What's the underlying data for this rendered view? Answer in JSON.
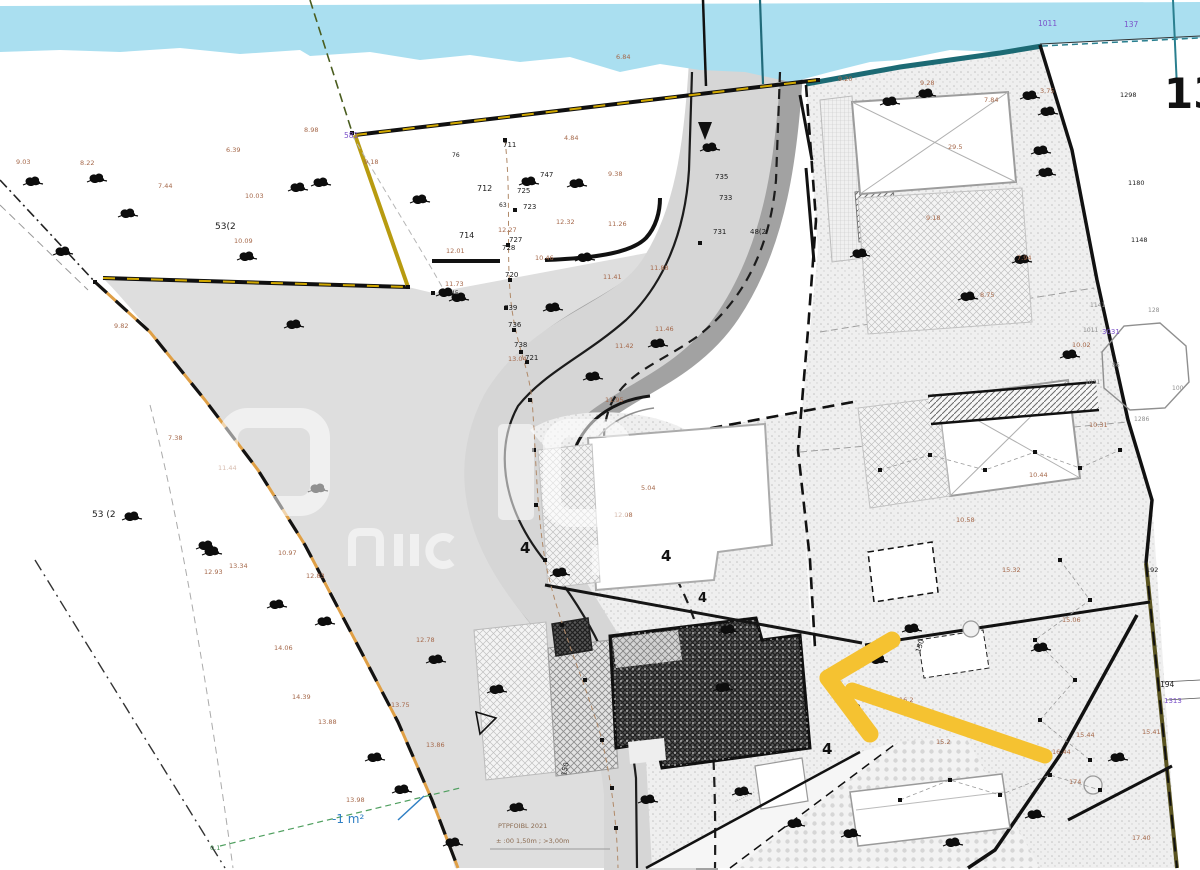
{
  "map_title": "cadastral-site-plan",
  "big_label": "13",
  "notes": {
    "survey_line1": "PTPFOIBL 2021",
    "survey_line2": "± :00 1,50m ; >3,00m"
  },
  "colors": {
    "water": "#aadff0",
    "water_edge": "#1c6a74",
    "road": "#d6d6d6",
    "road_dark": "#a2a2a2",
    "verge": "#dedede",
    "boundary_yellow": "#d1a800",
    "boundary_orange": "#df9f45",
    "arrow": "#f5c231",
    "note_blue": "#2f7fc4",
    "label_brown": "#a5684a",
    "label_purple": "#7b52c9",
    "highlight_outline": "#101010"
  },
  "labels": [
    [
      "712",
      477,
      191,
      "bk",
      8
    ],
    [
      "714",
      459,
      238,
      "bk",
      8
    ],
    [
      "711",
      503,
      147,
      "bk",
      7
    ],
    [
      "76",
      452,
      157,
      "bk",
      6
    ],
    [
      "747",
      540,
      177,
      "bk",
      7
    ],
    [
      "725",
      517,
      193,
      "bk",
      7
    ],
    [
      "723",
      523,
      209,
      "bk",
      7
    ],
    [
      "63",
      499,
      207,
      "bk",
      6
    ],
    [
      "727",
      509,
      242,
      "bk",
      7
    ],
    [
      "728",
      502,
      250,
      "bk",
      7
    ],
    [
      "720",
      505,
      277,
      "bk",
      7
    ],
    [
      "739",
      504,
      310,
      "bk",
      7
    ],
    [
      "736",
      508,
      327,
      "bk",
      7
    ],
    [
      "738",
      514,
      347,
      "bk",
      7
    ],
    [
      "721",
      525,
      360,
      "bk",
      7
    ],
    [
      "45",
      451,
      295,
      "bk",
      6
    ],
    [
      "735",
      715,
      179,
      "bk",
      7
    ],
    [
      "733",
      719,
      200,
      "bk",
      7
    ],
    [
      "731",
      713,
      234,
      "bk",
      7
    ],
    [
      "48(2",
      750,
      234,
      "bk",
      7
    ],
    [
      "53(2",
      215,
      229,
      "bk",
      9
    ],
    [
      "53 (2",
      92,
      517,
      "bk",
      9
    ],
    [
      "192",
      1146,
      572,
      "bk",
      6.5
    ],
    [
      "194",
      1160,
      687,
      "bk",
      7.5
    ],
    [
      "1180",
      1128,
      185,
      "bk",
      6.5
    ],
    [
      "1148",
      1131,
      242,
      "bk",
      6.5
    ],
    [
      "1298",
      1120,
      97,
      "bk",
      6.5
    ],
    [
      "581",
      344,
      138,
      "pu",
      7.5
    ],
    [
      "1011",
      1038,
      26,
      "pu",
      7.5
    ],
    [
      "137",
      1124,
      27,
      "pu",
      7.5
    ],
    [
      "3031",
      1102,
      334,
      "pu",
      7
    ],
    [
      "1313",
      1164,
      703,
      "pu",
      7
    ],
    [
      "9.03",
      16,
      164,
      "bn",
      6.5
    ],
    [
      "8.22",
      80,
      165,
      "bn",
      6.5
    ],
    [
      "7.44",
      158,
      188,
      "bn",
      6.5
    ],
    [
      "10.03",
      245,
      198,
      "bn",
      6.5
    ],
    [
      "6.39",
      226,
      152,
      "bn",
      6.5
    ],
    [
      "8.98",
      304,
      132,
      "bn",
      6.5
    ],
    [
      "9.18",
      364,
      164,
      "bn",
      6.5
    ],
    [
      "4.84",
      564,
      140,
      "bn",
      6.5
    ],
    [
      "9.38",
      608,
      176,
      "bn",
      6.5
    ],
    [
      "12.32",
      556,
      224,
      "bn",
      6.5
    ],
    [
      "11.26",
      608,
      226,
      "bn",
      6.5
    ],
    [
      "12.27",
      498,
      232,
      "bn",
      6.5
    ],
    [
      "10.46",
      535,
      260,
      "bn",
      6.5
    ],
    [
      "12.01",
      446,
      253,
      "bn",
      6.5
    ],
    [
      "11.88",
      650,
      270,
      "bn",
      6.5
    ],
    [
      "11.41",
      603,
      279,
      "bn",
      6.5
    ],
    [
      "11.46",
      655,
      331,
      "bn",
      6.5
    ],
    [
      "11.42",
      615,
      348,
      "bn",
      6.5
    ],
    [
      "13.04",
      508,
      361,
      "bn",
      6.5
    ],
    [
      "11.73",
      445,
      286,
      "bn",
      6.5
    ],
    [
      "10.09",
      234,
      243,
      "bn",
      6.5
    ],
    [
      "9.82",
      114,
      328,
      "bn",
      6.5
    ],
    [
      "11.44",
      218,
      470,
      "bn",
      6.5
    ],
    [
      "7.38",
      168,
      440,
      "bn",
      6.5
    ],
    [
      "10.97",
      278,
      555,
      "bn",
      6.5
    ],
    [
      "12.83",
      306,
      578,
      "bn",
      6.5
    ],
    [
      "12.93",
      204,
      574,
      "bn",
      6.5
    ],
    [
      "13.34",
      229,
      568,
      "bn",
      6.5
    ],
    [
      "14.06",
      274,
      650,
      "bn",
      6.5
    ],
    [
      "14.39",
      292,
      699,
      "bn",
      6.5
    ],
    [
      "13.88",
      318,
      724,
      "bn",
      6.5
    ],
    [
      "13.98",
      346,
      802,
      "bn",
      6.5
    ],
    [
      "13.86",
      426,
      747,
      "bn",
      6.5
    ],
    [
      "13.75",
      391,
      707,
      "bn",
      6.5
    ],
    [
      "12.78",
      416,
      642,
      "bn",
      6.5
    ],
    [
      "6.84",
      616,
      59,
      "bn",
      6.5
    ],
    [
      "9.20",
      838,
      81,
      "bn",
      6.5
    ],
    [
      "9.28",
      920,
      85,
      "bn",
      6.5
    ],
    [
      "7.84",
      984,
      102,
      "bn",
      6.5
    ],
    [
      "3.75",
      1040,
      93,
      "bn",
      6.5
    ],
    [
      "29.5",
      948,
      149,
      "bn",
      6.5
    ],
    [
      "9.18",
      926,
      220,
      "bn",
      6.5
    ],
    [
      "8.75",
      980,
      297,
      "bn",
      6.5
    ],
    [
      "7.94",
      1017,
      260,
      "bn",
      6.5
    ],
    [
      "10.02",
      1072,
      347,
      "bn",
      6.5
    ],
    [
      "10.31",
      1089,
      427,
      "bn",
      6.5
    ],
    [
      "10.44",
      1029,
      477,
      "bn",
      6.5
    ],
    [
      "10.58",
      956,
      522,
      "bn",
      6.5
    ],
    [
      "15.32",
      1002,
      572,
      "bn",
      6.5
    ],
    [
      "15.06",
      1062,
      622,
      "bn",
      6.5
    ],
    [
      "15.44",
      1076,
      737,
      "bn",
      6.5
    ],
    [
      "16.44",
      1052,
      754,
      "bn",
      6.5
    ],
    [
      "15.41",
      1142,
      734,
      "bn",
      6.5
    ],
    [
      "17.40",
      1132,
      840,
      "bn",
      6.5
    ],
    [
      "174",
      1069,
      784,
      "bn",
      6.5
    ],
    [
      "16.2",
      899,
      702,
      "bn",
      6.5
    ],
    [
      "15.2",
      936,
      744,
      "bn",
      6.5
    ],
    [
      "5.04",
      641,
      490,
      "bn",
      6.5
    ],
    [
      "12.08",
      614,
      517,
      "bn",
      6.5
    ],
    [
      "11.95",
      605,
      402,
      "bn",
      6.5
    ],
    [
      "-1 m²",
      332,
      823,
      "bl",
      12
    ],
    [
      "0.1",
      210,
      850,
      "gn",
      6.5
    ],
    [
      "1141",
      1090,
      307,
      "gy",
      6
    ],
    [
      "128",
      1148,
      312,
      "gy",
      6
    ],
    [
      "1011",
      1083,
      332,
      "gy",
      6
    ],
    [
      "1031",
      1085,
      384,
      "gy",
      6
    ],
    [
      "100",
      1172,
      390,
      "gy",
      6
    ],
    [
      "86",
      1112,
      367,
      "gy",
      6
    ],
    [
      "1286",
      1134,
      421,
      "gy",
      6
    ],
    [
      "150",
      566,
      776,
      "bk",
      7,
      -78
    ],
    [
      "150",
      920,
      653,
      "bk",
      7,
      -72
    ],
    [
      "170",
      856,
      717,
      "bk",
      7,
      -70
    ],
    [
      "4",
      520,
      553,
      "b4",
      15
    ],
    [
      "4",
      661,
      561,
      "b4",
      15
    ],
    [
      "4",
      698,
      602,
      "b4",
      13
    ],
    [
      "4",
      822,
      754,
      "b4",
      15
    ],
    [
      "··········",
      736,
      804,
      "gy",
      7,
      -27
    ]
  ],
  "trees": [
    [
      33,
      182
    ],
    [
      97,
      179
    ],
    [
      128,
      214
    ],
    [
      63,
      252
    ],
    [
      298,
      188
    ],
    [
      321,
      183
    ],
    [
      420,
      200
    ],
    [
      247,
      257
    ],
    [
      294,
      325
    ],
    [
      132,
      517
    ],
    [
      206,
      546
    ],
    [
      212,
      552
    ],
    [
      277,
      605
    ],
    [
      325,
      622
    ],
    [
      375,
      758
    ],
    [
      577,
      184
    ],
    [
      529,
      182
    ],
    [
      585,
      258
    ],
    [
      560,
      573
    ],
    [
      446,
      293
    ],
    [
      459,
      298
    ],
    [
      318,
      489
    ],
    [
      710,
      148
    ],
    [
      553,
      308
    ],
    [
      658,
      344
    ],
    [
      890,
      102
    ],
    [
      926,
      94
    ],
    [
      1030,
      96
    ],
    [
      1041,
      151
    ],
    [
      1046,
      173
    ],
    [
      1048,
      112
    ],
    [
      968,
      297
    ],
    [
      1022,
      260
    ],
    [
      860,
      254
    ],
    [
      1070,
      355
    ],
    [
      1041,
      648
    ],
    [
      1118,
      758
    ],
    [
      1035,
      815
    ],
    [
      953,
      843
    ],
    [
      878,
      660
    ],
    [
      912,
      629
    ],
    [
      728,
      630
    ],
    [
      723,
      688
    ],
    [
      648,
      800
    ],
    [
      742,
      792
    ],
    [
      795,
      824
    ],
    [
      851,
      834
    ],
    [
      402,
      790
    ],
    [
      453,
      843
    ],
    [
      517,
      808
    ],
    [
      593,
      377
    ],
    [
      497,
      690
    ],
    [
      436,
      660
    ]
  ],
  "points": [
    [
      505,
      140
    ],
    [
      515,
      210
    ],
    [
      508,
      245
    ],
    [
      510,
      280
    ],
    [
      506,
      308
    ],
    [
      514,
      330
    ],
    [
      521,
      352
    ],
    [
      527,
      362
    ],
    [
      530,
      400
    ],
    [
      534,
      450
    ],
    [
      536,
      505
    ],
    [
      545,
      560
    ],
    [
      562,
      625
    ],
    [
      585,
      680
    ],
    [
      602,
      740
    ],
    [
      612,
      788
    ],
    [
      616,
      828
    ],
    [
      880,
      470
    ],
    [
      930,
      455
    ],
    [
      985,
      470
    ],
    [
      1035,
      452
    ],
    [
      1080,
      468
    ],
    [
      1120,
      450
    ],
    [
      1060,
      560
    ],
    [
      1090,
      600
    ],
    [
      1035,
      640
    ],
    [
      1075,
      680
    ],
    [
      1040,
      720
    ],
    [
      1090,
      760
    ],
    [
      900,
      800
    ],
    [
      950,
      780
    ],
    [
      1000,
      795
    ],
    [
      1050,
      775
    ],
    [
      1100,
      790
    ],
    [
      352,
      133
    ],
    [
      408,
      287
    ],
    [
      818,
      80
    ],
    [
      95,
      282
    ],
    [
      700,
      243
    ],
    [
      433,
      293
    ]
  ],
  "arrow": {
    "segments": [
      [
        828,
        678,
        892,
        640,
        17
      ],
      [
        828,
        678,
        870,
        734,
        17
      ],
      [
        852,
        690,
        1045,
        756,
        15
      ]
    ]
  }
}
